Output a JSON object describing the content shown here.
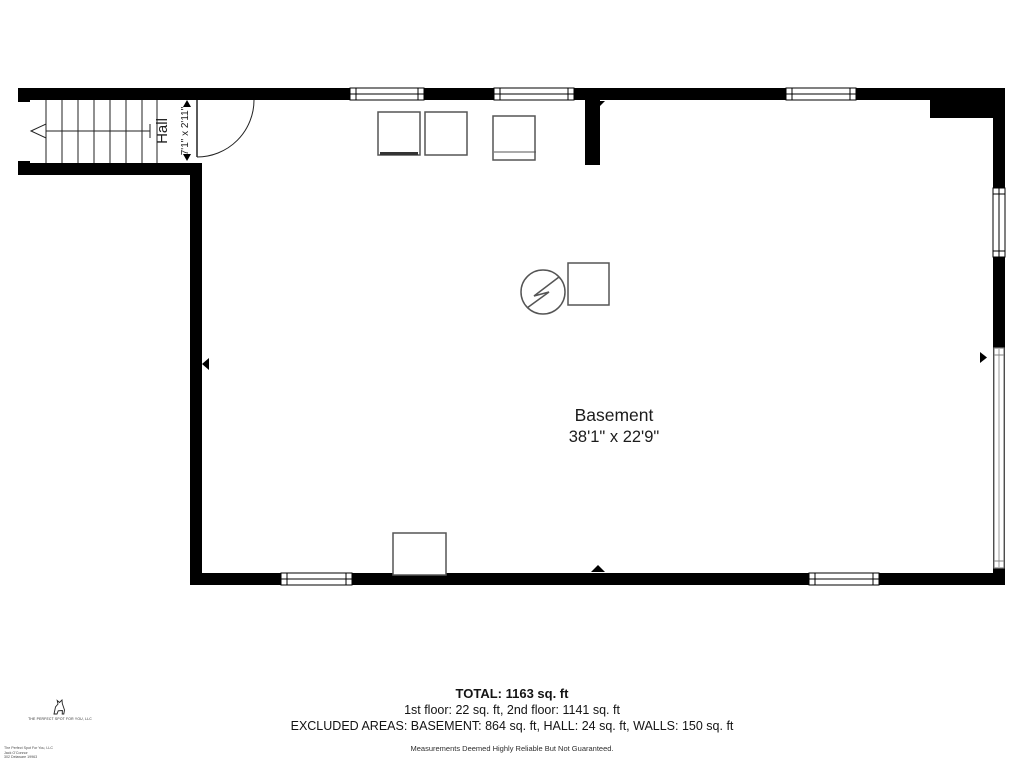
{
  "rooms": {
    "basement": {
      "label": "Basement",
      "dimensions": "38'1\" x 22'9\""
    },
    "hall": {
      "label": "Hall",
      "dimensions": "7'1\" x 2'11\""
    }
  },
  "summary": {
    "total": "TOTAL: 1163 sq. ft",
    "floors": "1st floor: 22 sq. ft, 2nd floor: 1141 sq. ft",
    "excluded": "EXCLUDED AREAS: BASEMENT: 864 sq. ft, HALL: 24 sq. ft, WALLS: 150 sq. ft",
    "disclaimer": "Measurements Deemed Highly Reliable But Not Guaranteed."
  },
  "branding": {
    "company": "THE PERFECT SPOT FOR YOU, LLC",
    "fine_print": [
      "The Perfect Spot For You, LLC",
      "Jack O'Connor",
      "302 Delaware 19963"
    ]
  },
  "symbols": {
    "water_heater": "circle-with-zigzag",
    "stairs": "treads-with-direction-arrow",
    "door": "quarter-arc-swing",
    "logo": "dog-silhouette"
  },
  "colors": {
    "wall": "#000000",
    "furniture_outline": "#555555",
    "long_window_outline": "#808080",
    "text": "#1c1c1c"
  }
}
